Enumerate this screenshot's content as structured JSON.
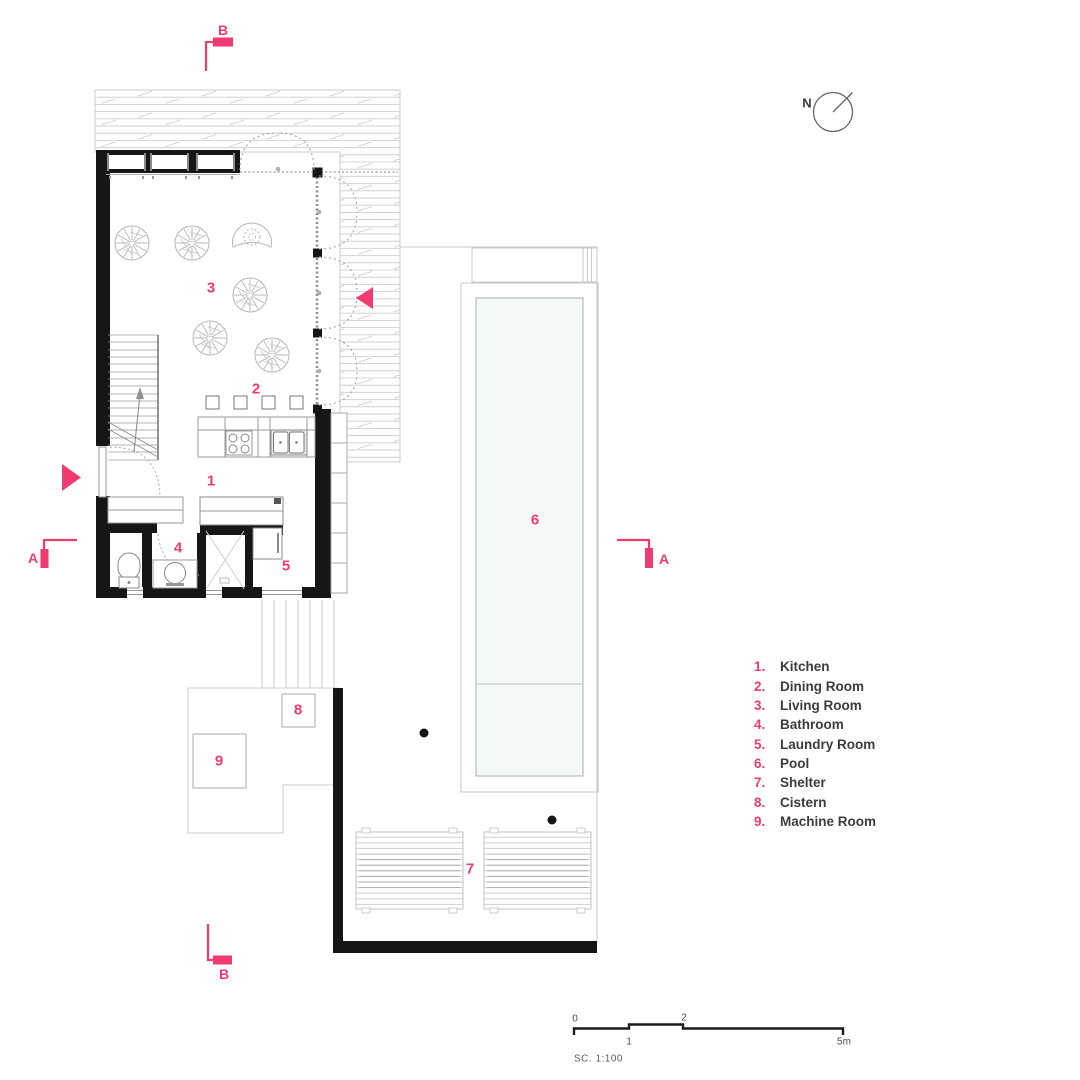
{
  "colors": {
    "accent": "#f13a6f",
    "wall": "#161616",
    "line_gray": "#c3c3c3",
    "pool_water": "#f3f9f9"
  },
  "north": {
    "label": "N"
  },
  "sections": {
    "top_label": "B",
    "bottom_label": "B",
    "left_label": "A",
    "right_label": "A"
  },
  "rooms": [
    {
      "number": "1",
      "num_label": "1.",
      "name": "Kitchen"
    },
    {
      "number": "2",
      "num_label": "2.",
      "name": "Dining Room"
    },
    {
      "number": "3",
      "num_label": "3.",
      "name": "Living Room"
    },
    {
      "number": "4",
      "num_label": "4.",
      "name": "Bathroom"
    },
    {
      "number": "5",
      "num_label": "5.",
      "name": "Laundry Room"
    },
    {
      "number": "6",
      "num_label": "6.",
      "name": "Pool"
    },
    {
      "number": "7",
      "num_label": "7.",
      "name": "Shelter"
    },
    {
      "number": "8",
      "num_label": "8.",
      "name": "Cistern"
    },
    {
      "number": "9",
      "num_label": "9.",
      "name": "Machine Room"
    }
  ],
  "scalebar": {
    "tick_0": "0",
    "tick_1": "1",
    "tick_2": "2",
    "tick_5": "5m",
    "scale_label": "SC. 1:100"
  }
}
